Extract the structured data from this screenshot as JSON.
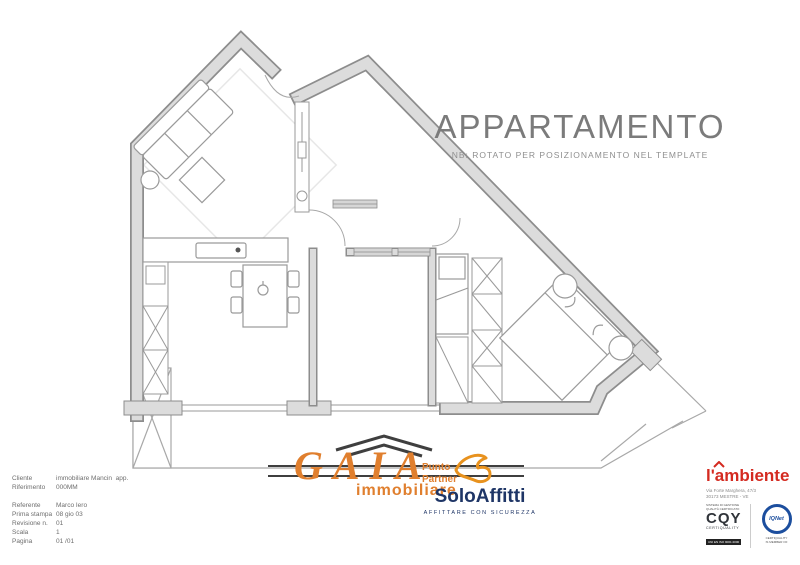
{
  "page": {
    "title": "APPARTAMENTO",
    "subtitle": "NB: ROTATO PER POSIZIONAMENTO NEL TEMPLATE"
  },
  "footer": {
    "info": {
      "rows": [
        {
          "label": "Cliente",
          "value": "immobiliare Mancin  app."
        },
        {
          "label": "Riferimento",
          "value": "000MM"
        },
        {
          "label": "Referente",
          "value": "Marco Iero"
        },
        {
          "label": "Prima stampa",
          "value": "08 gio 03"
        },
        {
          "label": "Revisione n.",
          "value": "01"
        },
        {
          "label": "Scala",
          "value": "1"
        },
        {
          "label": "Pagina",
          "value": "01 /01"
        }
      ]
    },
    "gaia": {
      "name": "GAIA",
      "sub": "immobiliare"
    },
    "partner": {
      "line1": "Punto",
      "line2": "Partner"
    },
    "soloaffitti": {
      "name": "SoloAffitti",
      "tagline": "AFFITTARE CON SICUREZZA"
    },
    "ambiente": {
      "name": "l'ambiente",
      "address_line1": "Via Forte Marghera, 47/3",
      "address_line2": "30173 MESTRE - VE",
      "cert1": {
        "top1": "SISTEMA DI GESTIONE",
        "top2": "QUALITÀ CERTIFICATO",
        "main": "CQY",
        "sub": "CERTIQUALITY",
        "bar": "UNI EN ISO 9001:2000"
      },
      "cert2": {
        "main": "IQNet",
        "sub1": "CERTIQUALITY",
        "sub2": "IS MEMBER OF"
      }
    }
  },
  "colors": {
    "accent_orange": "#e07f2e",
    "navy_blue": "#1e3566",
    "logo_red": "#d42a20",
    "cert_blue": "#1c4e9e",
    "wall_gray": "#dcdcdc",
    "wall_edge_gray": "#8d8d8d",
    "title_gray": "#7b7b7b"
  }
}
